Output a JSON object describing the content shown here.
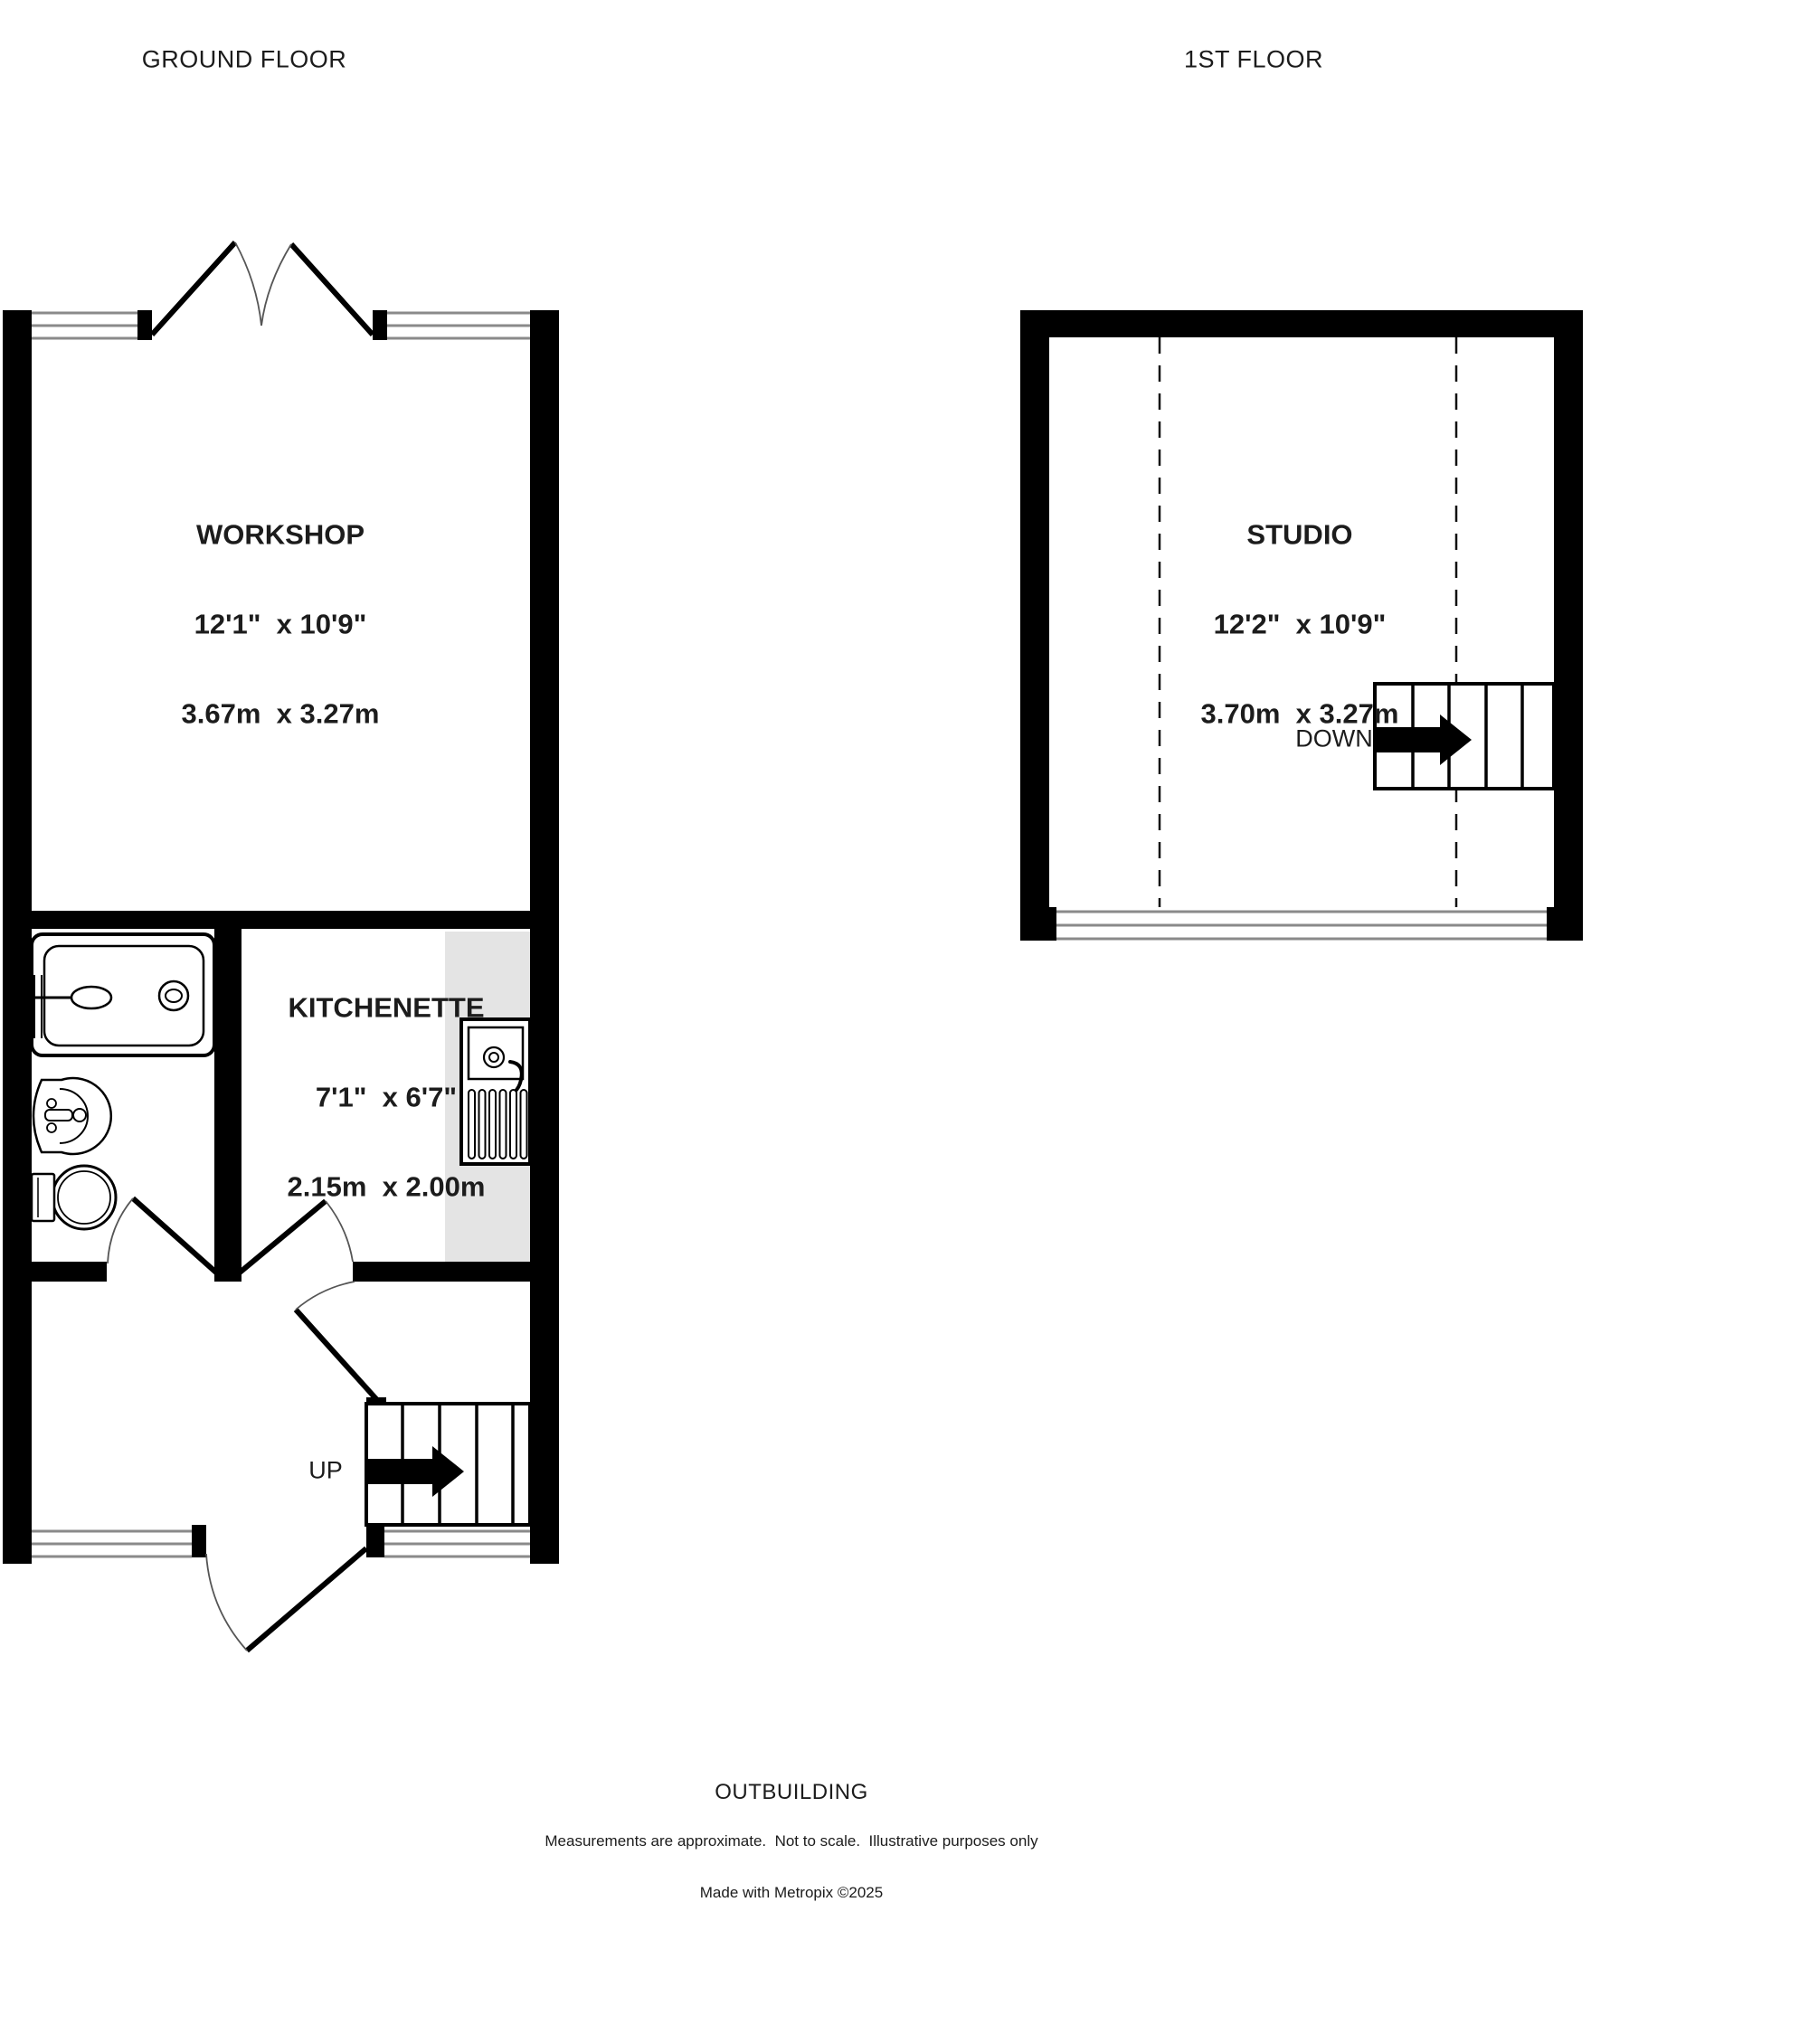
{
  "floors": {
    "ground": {
      "title": "GROUND FLOOR"
    },
    "first": {
      "title": "1ST FLOOR"
    }
  },
  "building_label": "OUTBUILDING",
  "rooms": {
    "workshop": {
      "name": "WORKSHOP",
      "size_imperial": "12'1\"  x 10'9\"",
      "size_metric": "3.67m  x 3.27m"
    },
    "studio": {
      "name": "STUDIO",
      "size_imperial": "12'2\"  x 10'9\"",
      "size_metric": "3.70m  x 3.27m"
    },
    "kitchenette": {
      "name": "KITCHENETTE",
      "size_imperial": "7'1\"  x 6'7\"",
      "size_metric": "2.15m  x 2.00m"
    }
  },
  "stairs": {
    "up": "UP",
    "down": "DOWN"
  },
  "footer": {
    "line1": "Measurements are approximate.  Not to scale.  Illustrative purposes only",
    "line2": "Made with Metropix ©2025"
  },
  "colors": {
    "wall": "#000000",
    "window_line": "#8a8a8a",
    "counter": "#e4e4e4",
    "text": "#1c1c1c"
  }
}
